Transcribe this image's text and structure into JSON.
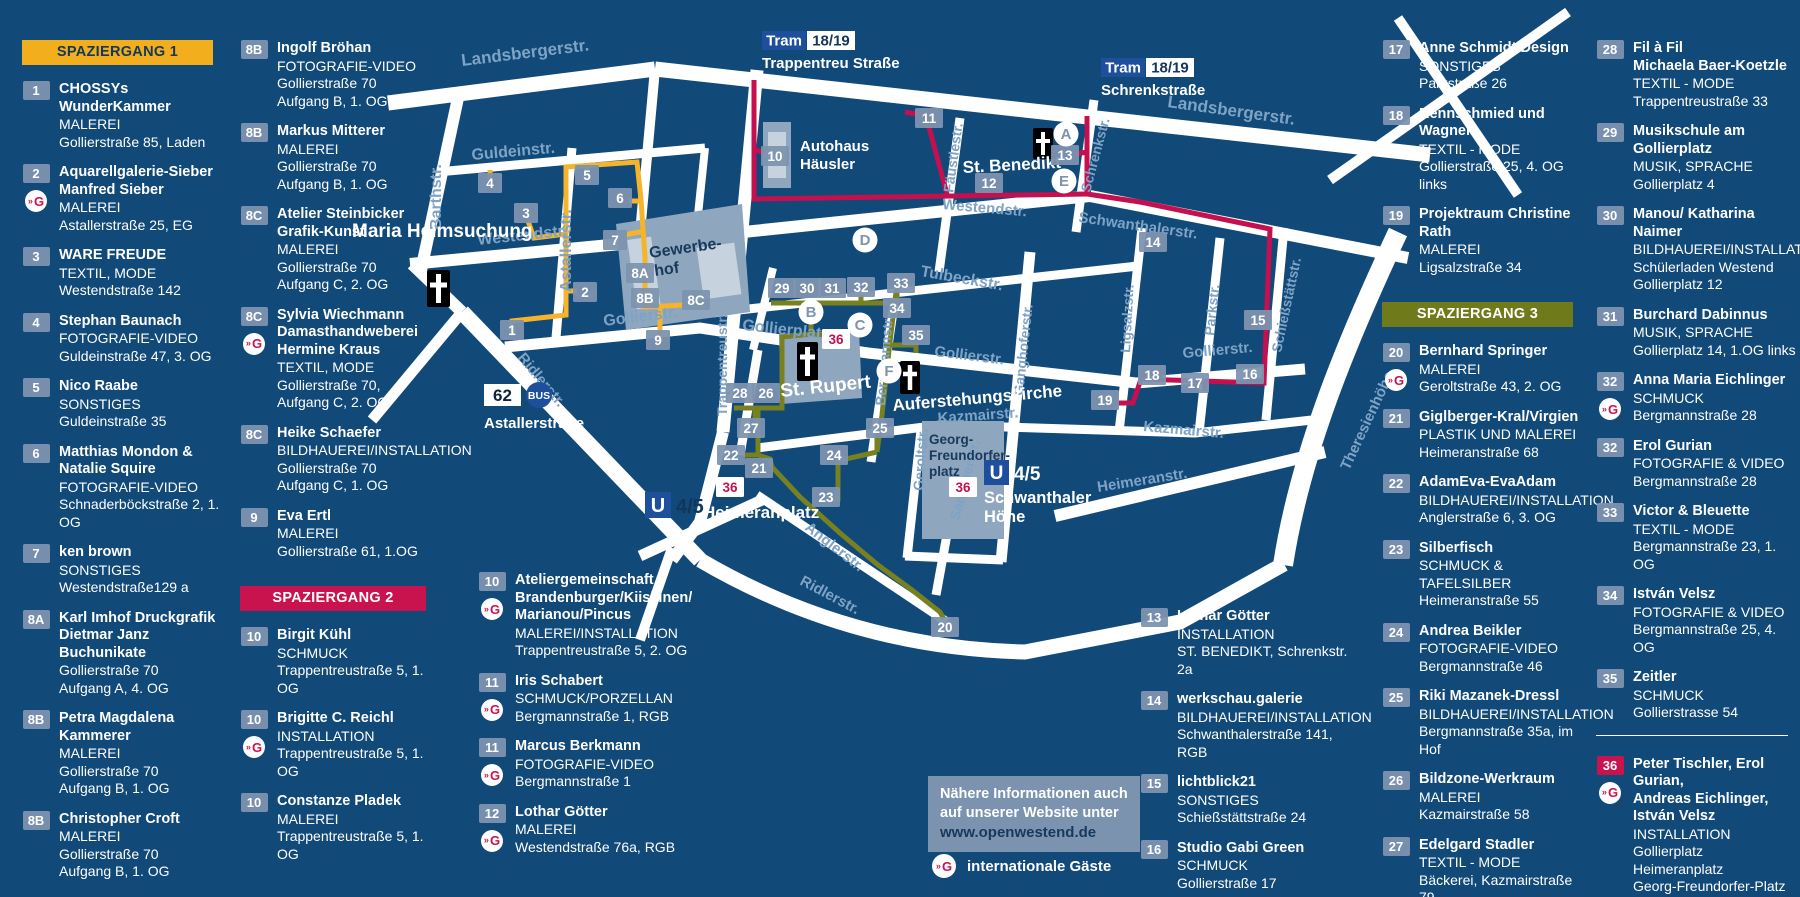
{
  "colors": {
    "background": "#114979",
    "street": "#ffffff",
    "street_label": "#7fa3c5",
    "marker_steel": "#7d93af",
    "block_gray": "#8ea6be",
    "block_light": "#c6d3df",
    "transit_blue": "#1d4f9c",
    "routes": {
      "walk1": "#f6b42a",
      "walk2": "#c4104e",
      "walk3": "#77811f"
    }
  },
  "walks": [
    {
      "label": "SPAZIERGANG 1",
      "color": "#f2ae1c",
      "text": "#14375c"
    },
    {
      "label": "SPAZIERGANG 2",
      "color": "#c9134f",
      "text": "#ffffff"
    },
    {
      "label": "SPAZIERGANG 3",
      "color": "#6f7a1b",
      "text": "#ffffff"
    }
  ],
  "info_box": {
    "line1": "Nähere Informationen auch",
    "line2": "auf unserer Website unter",
    "url": "www.openwestend.de"
  },
  "legend": {
    "guest_icon": "»G",
    "guest_label": "internationale Gäste"
  },
  "directory": {
    "columns": [
      {
        "items": [
          {
            "header": 0
          },
          {
            "n": "1",
            "name": "CHOSSYs WunderKammer",
            "type": "MALEREI",
            "addr": "Gollierstraße 85, Laden"
          },
          {
            "n": "2",
            "name": "Aquarellgalerie-Sieber\nManfred Sieber",
            "type": "MALEREI",
            "addr": "Astallerstraße 25, EG",
            "g": 1
          },
          {
            "n": "3",
            "name": "WARE FREUDE",
            "type": "TEXTIL, MODE",
            "addr": "Westendstraße 142"
          },
          {
            "n": "4",
            "name": "Stephan Baunach",
            "type": "FOTOGRAFIE-VIDEO",
            "addr": "Guldeinstraße 47, 3. OG"
          },
          {
            "n": "5",
            "name": "Nico Raabe",
            "type": "SONSTIGES",
            "addr": "Guldeinstraße 35"
          },
          {
            "n": "6",
            "name": "Matthias Mondon &\nNatalie Squire",
            "type": "FOTOGRAFIE-VIDEO",
            "addr": "Schnaderböckstraße 2, 1. OG"
          },
          {
            "n": "7",
            "name": "ken brown",
            "type": "SONSTIGES",
            "addr": "Westendstraße129 a"
          },
          {
            "n": "8A",
            "name": "Karl Imhof Druckgrafik\nDietmar Janz  Buchunikate",
            "type": "",
            "addr": "Gollierstraße 70\nAufgang A, 4. OG"
          },
          {
            "n": "8B",
            "name": "Petra Magdalena Kammerer",
            "type": "MALEREI",
            "addr": "Gollierstraße 70\nAufgang B, 1. OG"
          },
          {
            "n": "8B",
            "name": "Christopher Croft",
            "type": "MALEREI",
            "addr": "Gollierstraße 70\nAufgang B, 1. OG"
          }
        ]
      },
      {
        "items": [
          {
            "n": "8B",
            "name": "Ingolf Bröhan",
            "type": "FOTOGRAFIE-VIDEO",
            "addr": "Gollierstraße 70\nAufgang B, 1. OG"
          },
          {
            "n": "8B",
            "name": "Markus Mitterer",
            "type": "MALEREI",
            "addr": "Gollierstraße 70\nAufgang B, 1. OG"
          },
          {
            "n": "8C",
            "name": "Atelier Steinbicker\nGrafik-Kunst",
            "type": "MALEREI",
            "addr": "Gollierstraße 70\nAufgang C, 2. OG"
          },
          {
            "n": "8C",
            "name": "Sylvia Wiechmann\nDamasthandweberei\nHermine Kraus",
            "type": "TEXTIL, MODE",
            "addr": "Gollierstraße 70,\nAufgang C, 2. OG",
            "g": 1
          },
          {
            "n": "8C",
            "name": "Heike Schaefer",
            "type": "BILDHAUEREI/INSTALLATION",
            "addr": "Gollierstraße 70\nAufgang C, 1. OG"
          },
          {
            "n": "9",
            "name": "Eva Ertl",
            "type": "MALEREI",
            "addr": "Gollierstraße 61, 1.OG"
          },
          {
            "header": 1
          },
          {
            "n": "10",
            "name": "Birgit Kühl",
            "type": "SCHMUCK",
            "addr": "Trappentreustraße 5, 1. OG"
          },
          {
            "n": "10",
            "name": "Brigitte C. Reichl",
            "type": "INSTALLATION",
            "addr": "Trappentreustraße 5, 1. OG",
            "g": 1
          },
          {
            "n": "10",
            "name": "Constanze Pladek",
            "type": "MALEREI",
            "addr": "Trappentreustraße 5, 1. OG"
          }
        ]
      },
      {
        "items": [
          {
            "n": "10",
            "name": "Ateliergemeinschaft\nBrandenburger/Kiiskinen/\nMarianou/Pincus",
            "type": "MALEREI/INSTALLATION",
            "addr": "Trappentreustraße 5, 2. OG",
            "g": 1
          },
          {
            "n": "11",
            "name": "Iris Schabert",
            "type": "SCHMUCK/PORZELLAN",
            "addr": "Bergmannstraße 1, RGB",
            "g": 1
          },
          {
            "n": "11",
            "name": "Marcus Berkmann",
            "type": "FOTOGRAFIE-VIDEO",
            "addr": "Bergmannstraße 1",
            "g": 1
          },
          {
            "n": "12",
            "name": "Lothar Götter",
            "type": "MALEREI",
            "addr": "Westendstraße 76a, RGB",
            "g": 1
          }
        ]
      },
      {
        "items": [
          {
            "n": "13",
            "name": "Lothar Götter",
            "type": "INSTALLATION",
            "addr": "ST. BENEDIKT, Schrenkstr. 2a"
          },
          {
            "n": "14",
            "name": "werkschau.galerie",
            "type": "BILDHAUEREI/INSTALLATION",
            "addr": "Schwanthalerstraße 141, RGB"
          },
          {
            "n": "15",
            "name": "lichtblick21",
            "type": "SONSTIGES",
            "addr": "Schießstättstraße 24"
          },
          {
            "n": "16",
            "name": "Studio Gabi Green",
            "type": "SCHMUCK",
            "addr": "Gollierstraße 17"
          }
        ]
      },
      {
        "items": [
          {
            "n": "17",
            "name": "Anne Schmidt Design",
            "type": "SONSTIGES",
            "addr": "Parkstraße 26"
          },
          {
            "n": "18",
            "name": "Rennschmied und Wagner",
            "type": "TEXTIL - MODE",
            "addr": "Gollierstraße 25, 4. OG links"
          },
          {
            "n": "19",
            "name": "Projektraum Christine Rath",
            "type": "MALEREI",
            "addr": "Ligsalzstraße 34"
          },
          {
            "header": 2
          },
          {
            "n": "20",
            "name": "Bernhard Springer",
            "type": "MALEREI",
            "addr": "Geroltstraße 43, 2. OG",
            "g": 1
          },
          {
            "n": "21",
            "name": "Giglberger-Kral/Virgien",
            "type": "PLASTIK UND MALEREI",
            "addr": "Heimeranstraße 68"
          },
          {
            "n": "22",
            "name": "AdamEva-EvaAdam",
            "type": "BILDHAUEREI/INSTALLATION",
            "addr": "Anglerstraße 6, 3. OG"
          },
          {
            "n": "23",
            "name": "Silberfisch",
            "type": "SCHMUCK & TAFELSILBER",
            "addr": "Heimeranstraße 55"
          },
          {
            "n": "24",
            "name": "Andrea Beikler",
            "type": "FOTOGRAFIE-VIDEO",
            "addr": "Bergmannstraße 46"
          },
          {
            "n": "25",
            "name": "Riki Mazanek-Dressl",
            "type": "BILDHAUEREI/INSTALLATION",
            "addr": "Bergmannstraße 35a, im Hof"
          },
          {
            "n": "26",
            "name": "Bildzone-Werkraum",
            "type": "MALEREI",
            "addr": "Kazmairstraße 58"
          },
          {
            "n": "27",
            "name": "Edelgard Stadler",
            "type": "TEXTIL - MODE",
            "addr": "Bäckerei, Kazmairstraße 79"
          }
        ]
      },
      {
        "items": [
          {
            "n": "28",
            "name": "Fil à Fil\nMichaela Baer-Koetzle",
            "type": "TEXTIL - MODE",
            "addr": "Trappentreustraße 33"
          },
          {
            "n": "29",
            "name": "Musikschule am Gollierplatz",
            "type": "MUSIK, SPRACHE",
            "addr": "Gollierplatz 4"
          },
          {
            "n": "30",
            "name": "Manou/ Katharina Naimer",
            "type": "BILDHAUEREI/INSTALLATION",
            "addr": "Schülerladen Westend\nGollierplatz 12"
          },
          {
            "n": "31",
            "name": "Burchard Dabinnus",
            "type": "MUSIK, SPRACHE",
            "addr": "Gollierplatz 14, 1.OG links"
          },
          {
            "n": "32",
            "name": "Anna Maria Eichlinger",
            "type": "SCHMUCK",
            "addr": "Bergmannstraße 28",
            "g": 1
          },
          {
            "n": "32",
            "name": "Erol Gurian",
            "type": "FOTOGRAFIE & VIDEO",
            "addr": "Bergmannstraße 28"
          },
          {
            "n": "33",
            "name": "Victor & Bleuette",
            "type": "TEXTIL - MODE",
            "addr": "Bergmannstraße 23, 1. OG"
          },
          {
            "n": "34",
            "name": "István Velsz",
            "type": "FOTOGRAFIE & VIDEO",
            "addr": "Bergmannstraße 25, 4. OG"
          },
          {
            "n": "35",
            "name": "Zeitler",
            "type": "SCHMUCK",
            "addr": "Gollierstrasse 54"
          },
          {
            "divider": true
          },
          {
            "n": "36",
            "name": "Peter Tischler, Erol Gurian,\nAndreas Eichlinger,\nIstván Velsz",
            "type": "INSTALLATION",
            "addr": "Gollierplatz\nHeimeranplatz\nGeorg-Freundorfer-Platz",
            "g": 1,
            "red": 1
          }
        ]
      }
    ]
  },
  "map": {
    "street_labels": [
      {
        "t": "Landsbergerstr.",
        "x": 462,
        "y": 66,
        "r": -7,
        "s": 17
      },
      {
        "t": "Landsbergerstr.",
        "x": 1167,
        "y": 107,
        "r": 8,
        "s": 17
      },
      {
        "t": "Guldeinstr.",
        "x": 472,
        "y": 160,
        "r": -5,
        "s": 16
      },
      {
        "t": "Barthstr.",
        "x": 441,
        "y": 230,
        "r": -90,
        "s": 16
      },
      {
        "t": "Westendstr.",
        "x": 478,
        "y": 245,
        "r": -6,
        "s": 16
      },
      {
        "t": "Astallerstr.",
        "x": 571,
        "y": 292,
        "r": -90,
        "s": 16
      },
      {
        "t": "Gollierstr.",
        "x": 604,
        "y": 326,
        "r": -7,
        "s": 16
      },
      {
        "t": "Ridlerstr.",
        "x": 517,
        "y": 358,
        "r": 50,
        "s": 15
      },
      {
        "t": "Trappentreustr.",
        "x": 727,
        "y": 416,
        "r": -90,
        "s": 14
      },
      {
        "t": "Westendstr.",
        "x": 942,
        "y": 209,
        "r": 5,
        "s": 15
      },
      {
        "t": "Tulbeckstr.",
        "x": 920,
        "y": 276,
        "r": 10,
        "s": 16
      },
      {
        "t": "Fäustlestr.",
        "x": 953,
        "y": 193,
        "r": -82,
        "s": 14
      },
      {
        "t": "Schrenkstr.",
        "x": 1090,
        "y": 193,
        "r": -75,
        "s": 14
      },
      {
        "t": "Schwanthalerstr.",
        "x": 1078,
        "y": 222,
        "r": 8,
        "s": 15
      },
      {
        "t": "Gollierstr.",
        "x": 934,
        "y": 356,
        "r": 7,
        "s": 15
      },
      {
        "t": "Gollierstr.",
        "x": 1183,
        "y": 358,
        "r": -5,
        "s": 15
      },
      {
        "t": "Bergmannstr.",
        "x": 885,
        "y": 406,
        "r": -85,
        "s": 14
      },
      {
        "t": "Ganghoferstr.",
        "x": 1023,
        "y": 396,
        "r": -84,
        "s": 14
      },
      {
        "t": "Ligsalzstr.",
        "x": 1130,
        "y": 353,
        "r": -87,
        "s": 14
      },
      {
        "t": "Parkstr.",
        "x": 1214,
        "y": 336,
        "r": -84,
        "s": 14
      },
      {
        "t": "Schießstättstr.",
        "x": 1281,
        "y": 353,
        "r": -78,
        "s": 14
      },
      {
        "t": "Kazmairstr.",
        "x": 938,
        "y": 423,
        "r": -4,
        "s": 15
      },
      {
        "t": "Kazmairstr.",
        "x": 1143,
        "y": 431,
        "r": 5,
        "s": 15
      },
      {
        "t": "Geroltstr.",
        "x": 923,
        "y": 491,
        "r": -86,
        "s": 14
      },
      {
        "t": "Sandtnerstr.",
        "x": 959,
        "y": 521,
        "r": -75,
        "s": 14
      },
      {
        "t": "Heimeranstr.",
        "x": 1098,
        "y": 492,
        "r": -9,
        "s": 15
      },
      {
        "t": "Anglerstr.",
        "x": 804,
        "y": 529,
        "r": 38,
        "s": 15
      },
      {
        "t": "Ridlerstr.",
        "x": 799,
        "y": 584,
        "r": 28,
        "s": 15
      },
      {
        "t": "Theresienhöhe",
        "x": 1349,
        "y": 471,
        "r": -65,
        "s": 15
      },
      {
        "t": "Gollierplatz",
        "x": 742,
        "y": 330,
        "r": 6,
        "s": 16
      }
    ],
    "markers": [
      {
        "t": "1",
        "x": 512,
        "y": 330
      },
      {
        "t": "2",
        "x": 585,
        "y": 292
      },
      {
        "t": "3",
        "x": 526,
        "y": 213
      },
      {
        "t": "4",
        "x": 490,
        "y": 183
      },
      {
        "t": "5",
        "x": 587,
        "y": 175
      },
      {
        "t": "6",
        "x": 620,
        "y": 198
      },
      {
        "t": "7",
        "x": 615,
        "y": 240
      },
      {
        "t": "8A",
        "x": 640,
        "y": 273
      },
      {
        "t": "8B",
        "x": 645,
        "y": 298
      },
      {
        "t": "8C",
        "x": 696,
        "y": 300
      },
      {
        "t": "9",
        "x": 658,
        "y": 340
      },
      {
        "t": "10",
        "x": 775,
        "y": 156
      },
      {
        "t": "11",
        "x": 929,
        "y": 118
      },
      {
        "t": "12",
        "x": 989,
        "y": 183
      },
      {
        "t": "13",
        "x": 1065,
        "y": 155
      },
      {
        "t": "14",
        "x": 1153,
        "y": 242
      },
      {
        "t": "15",
        "x": 1258,
        "y": 320
      },
      {
        "t": "16",
        "x": 1250,
        "y": 374
      },
      {
        "t": "17",
        "x": 1195,
        "y": 383
      },
      {
        "t": "18",
        "x": 1152,
        "y": 375
      },
      {
        "t": "19",
        "x": 1105,
        "y": 400
      },
      {
        "t": "20",
        "x": 945,
        "y": 627
      },
      {
        "t": "21",
        "x": 759,
        "y": 468
      },
      {
        "t": "22",
        "x": 731,
        "y": 455
      },
      {
        "t": "23",
        "x": 826,
        "y": 497
      },
      {
        "t": "24",
        "x": 834,
        "y": 455
      },
      {
        "t": "25",
        "x": 880,
        "y": 428
      },
      {
        "t": "26",
        "x": 766,
        "y": 393
      },
      {
        "t": "27",
        "x": 751,
        "y": 428
      },
      {
        "t": "28",
        "x": 740,
        "y": 393
      },
      {
        "t": "29",
        "x": 782,
        "y": 288
      },
      {
        "t": "30",
        "x": 807,
        "y": 288
      },
      {
        "t": "31",
        "x": 832,
        "y": 288
      },
      {
        "t": "32",
        "x": 861,
        "y": 287
      },
      {
        "t": "33",
        "x": 901,
        "y": 283
      },
      {
        "t": "34",
        "x": 897,
        "y": 308
      },
      {
        "t": "35",
        "x": 916,
        "y": 335
      },
      {
        "t": "36",
        "x": 836,
        "y": 339,
        "k": "r"
      },
      {
        "t": "36",
        "x": 963,
        "y": 487,
        "k": "r"
      },
      {
        "t": "36",
        "x": 730,
        "y": 487,
        "k": "r"
      },
      {
        "t": "A",
        "x": 1066,
        "y": 134,
        "k": "l"
      },
      {
        "t": "B",
        "x": 811,
        "y": 312,
        "k": "l"
      },
      {
        "t": "C",
        "x": 860,
        "y": 325,
        "k": "l"
      },
      {
        "t": "D",
        "x": 865,
        "y": 240,
        "k": "l"
      },
      {
        "t": "E",
        "x": 1064,
        "y": 181,
        "k": "l"
      },
      {
        "t": "F",
        "x": 889,
        "y": 371,
        "k": "l"
      }
    ],
    "landmarks": {
      "maria": "Maria Heimsuchung",
      "gewerbe_l1": "Gewerbe-",
      "gewerbe_l2": "hof",
      "autohaus_l1": "Autohaus",
      "autohaus_l2": "Häusler",
      "st_benedikt": "St. Benedikt",
      "st_rupert": "St. Rupert",
      "auferstehung": "Auferstehungskirche",
      "gfp_l1": "Georg-",
      "gfp_l2": "Freundorfer-",
      "gfp_l3": "platz",
      "heimeranplatz": "Heimeranplatz"
    },
    "transit": {
      "tram": "Tram",
      "tram_num": "18/19",
      "tram1_station": "Trappentreu Straße",
      "tram2_station": "Schrenkstraße",
      "u": "U",
      "u_num": "4/5",
      "u2_station_l1": "Schwanthaler",
      "u2_station_l2": "Höhe",
      "bus_num": "62",
      "bus_label": "BUS",
      "bus_station": "Astallerstraße"
    }
  }
}
